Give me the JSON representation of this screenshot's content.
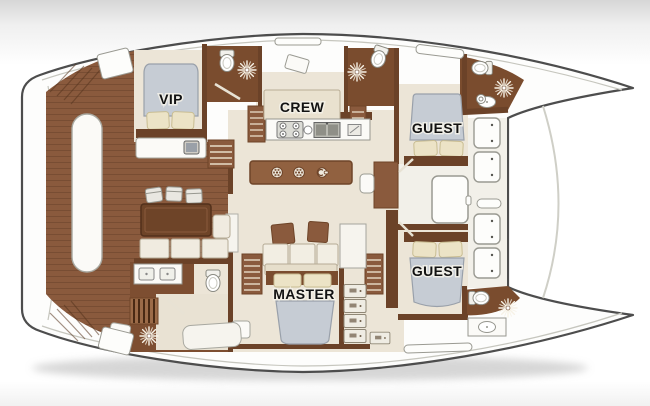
{
  "plan": {
    "type": "yacht-deck-plan",
    "vessel": "sailing catamaran",
    "view": "top-down interior layout, bow pointing right"
  },
  "cabins": [
    {
      "id": "vip",
      "label": "VIP"
    },
    {
      "id": "crew",
      "label": "CREW"
    },
    {
      "id": "guest-forward",
      "label": "GUEST"
    },
    {
      "id": "master",
      "label": "MASTER"
    },
    {
      "id": "guest-aft",
      "label": "GUEST"
    }
  ],
  "colors": {
    "deck_wood": "#8a5a3d",
    "deck_wood_dark": "#7a4c2e",
    "wall_brown": "#6b4228",
    "floor_cream": "#ece5d7",
    "bed_duvet_gray": "#c6ccd4",
    "pillow_cream": "#ece3c6",
    "hull_outline": "#4d4d4d",
    "background_top": "#d6d6d6"
  },
  "icons": {
    "starburst": "ceiling-light / shower spotlight",
    "rosette": "galley island plate",
    "faucet": "island faucet",
    "stove": "four-burner cooktop",
    "double_sink": "galley double sink",
    "toilet": "toilet",
    "sink": "washbasin",
    "hatch": "deck hatch",
    "winch": "deck winch",
    "tv": "tv cabinet"
  }
}
